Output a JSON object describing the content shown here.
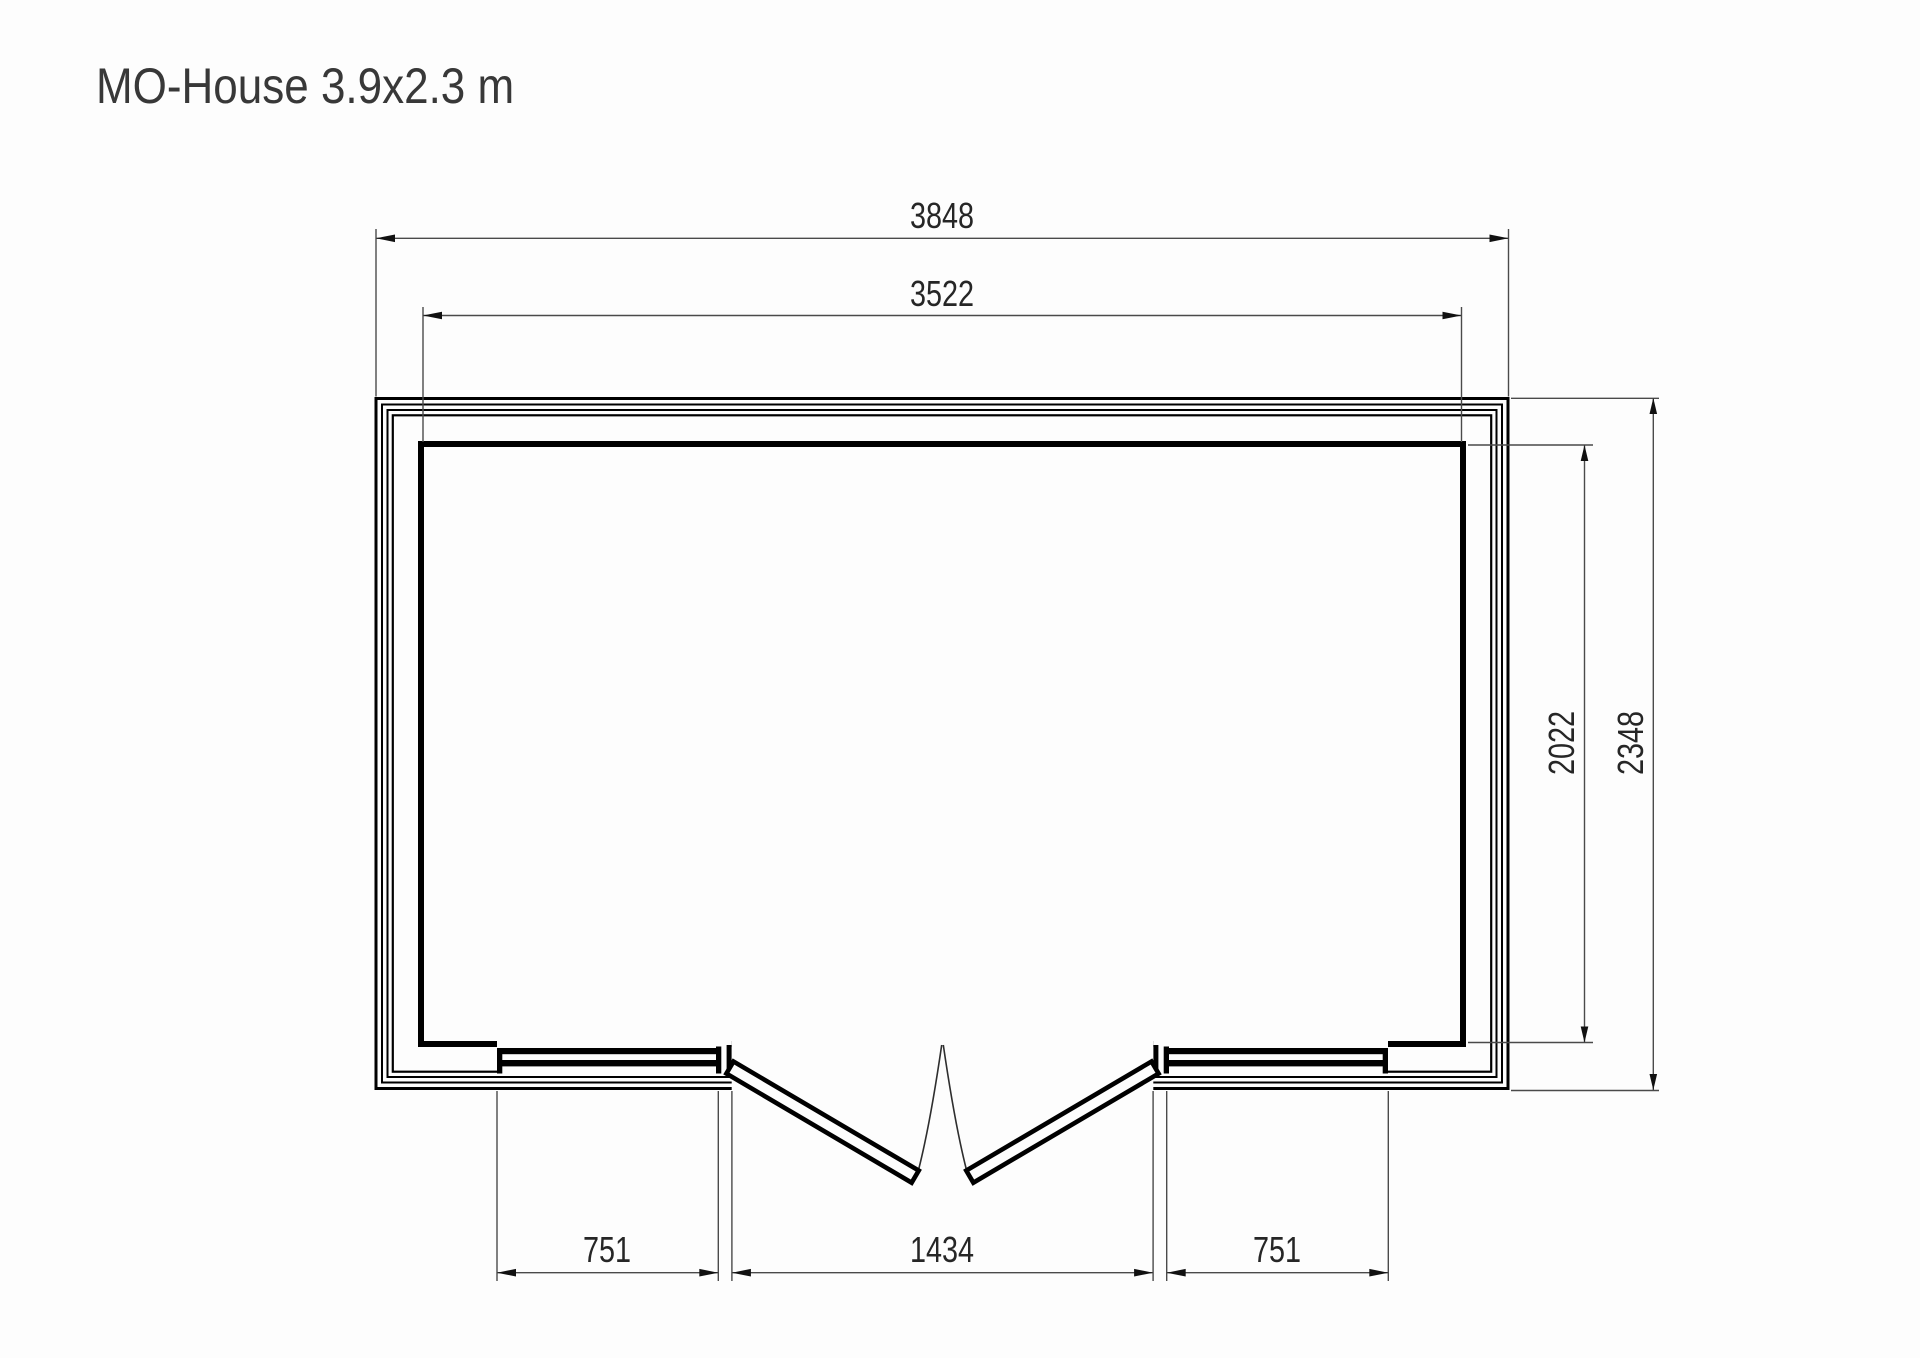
{
  "title": "MO-House 3.9x2.3 m",
  "plan": {
    "dimensions": {
      "outer_width": "3848",
      "inner_width": "3522",
      "inner_depth": "2022",
      "outer_depth": "2348",
      "left_window": "751",
      "door_opening": "1434",
      "right_window": "751"
    },
    "colors": {
      "wall_line": "#000000",
      "dim_line": "#4a4a4a",
      "dim_text": "#262626",
      "title_text": "#383838",
      "background": "#fdfdfd"
    }
  }
}
